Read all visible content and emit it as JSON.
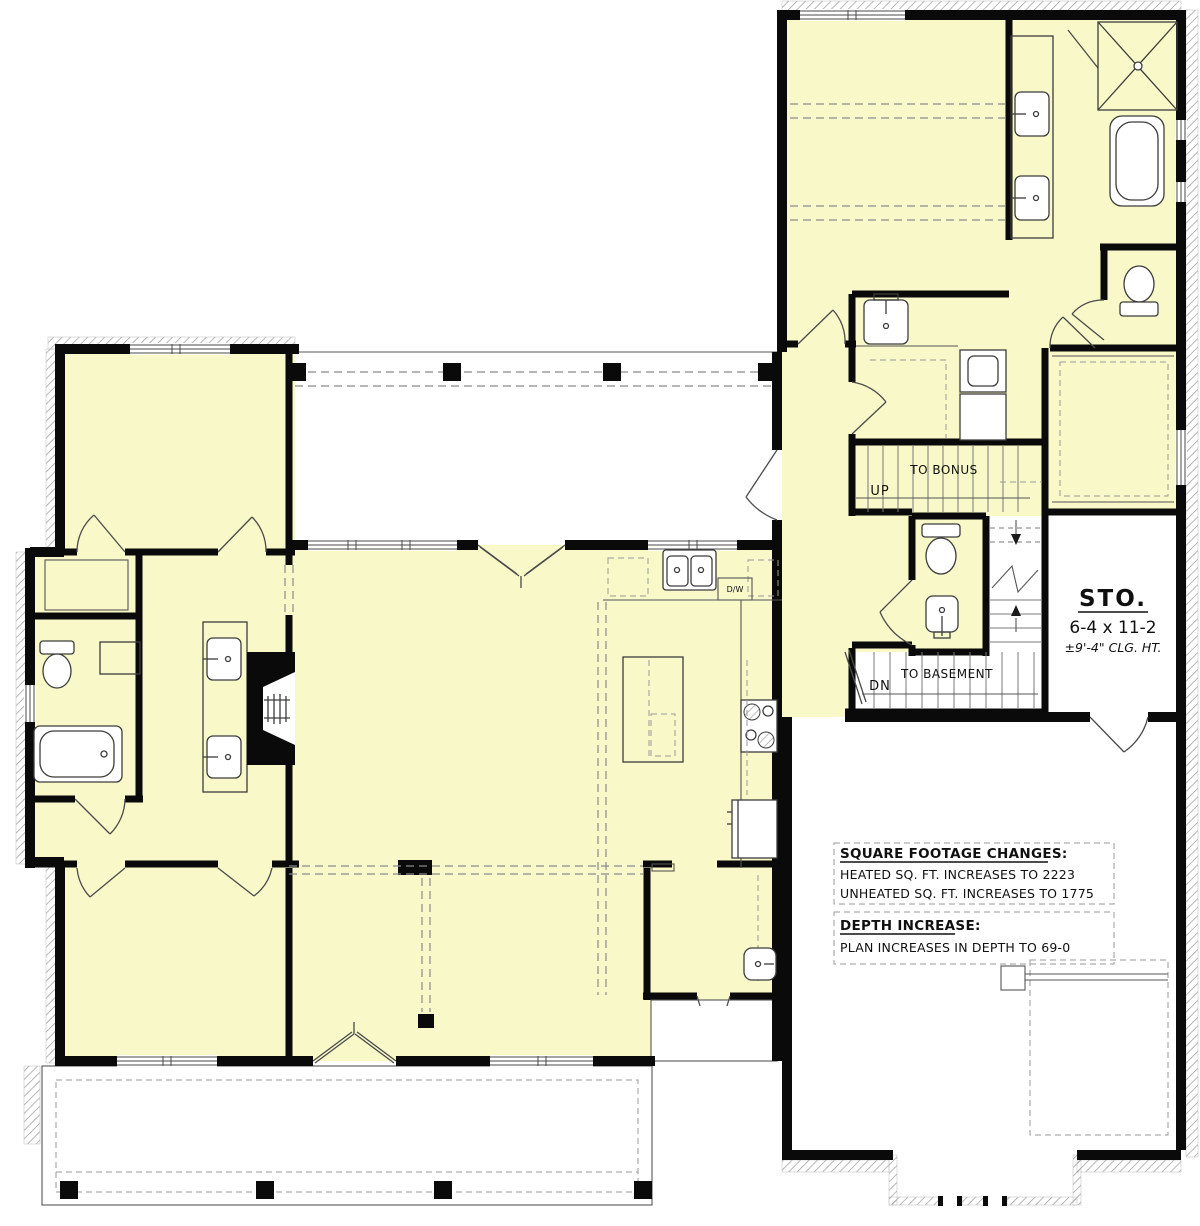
{
  "title": "First floor plan with basement stair option",
  "colors": {
    "heated_fill": "#F8F8C9",
    "unheated_fill": "#FFFFFF",
    "wall": "#0A0A0A",
    "line": "#3C3C3C",
    "dash": "#8A8A8A",
    "hatch": "#9A9A9A"
  },
  "rooms": {
    "storage": {
      "name": "STO.",
      "dimensions": "6-4 x 11-2",
      "ceiling_height": "±9'-4\" CLG. HT."
    }
  },
  "stairs": {
    "up_label": "UP",
    "up_destination": "TO BONUS",
    "down_label": "DN",
    "down_destination": "TO BASEMENT"
  },
  "appliances": {
    "dishwasher_label": "D/W"
  },
  "notes": {
    "square_footage_heading": "SQUARE FOOTAGE CHANGES:",
    "heated_line": "HEATED SQ. FT. INCREASES TO 2223",
    "unheated_line": "UNHEATED SQ. FT. INCREASES TO 1775",
    "depth_heading": "DEPTH INCREASE:",
    "depth_line": "PLAN INCREASES IN DEPTH TO 69-0"
  }
}
